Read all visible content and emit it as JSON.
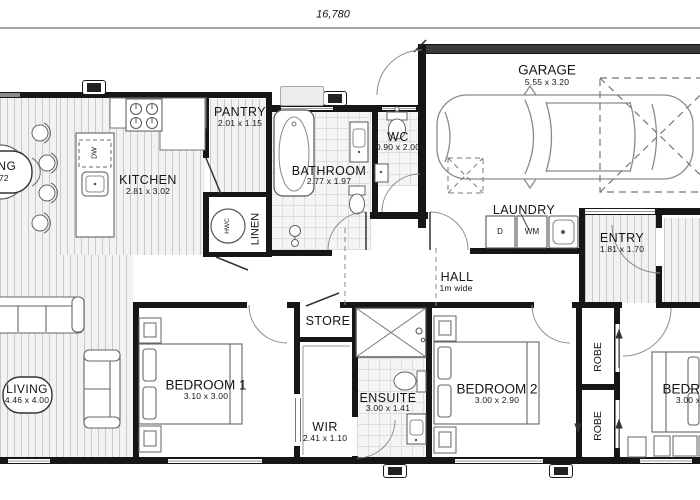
{
  "dimension_total": "16,780",
  "labels": {
    "garage": {
      "name": "GARAGE",
      "dims": "5.55 x 3.20"
    },
    "pantry": {
      "name": "PANTRY",
      "dims": "2.01 x 1.15"
    },
    "kitchen": {
      "name": "KITCHEN",
      "dims": "2.81 x 3.02"
    },
    "bathroom": {
      "name": "BATHROOM",
      "dims": "2.77 x 1.97"
    },
    "wc": {
      "name": "WC",
      "dims": "0.90 x 2.00"
    },
    "laundry": {
      "name": "LAUNDRY",
      "dryer": "D",
      "washer": "WM"
    },
    "entry": {
      "name": "ENTRY",
      "dims": "1.81 x 1.70"
    },
    "hall": {
      "name": "HALL",
      "dims": "1m wide"
    },
    "linen": {
      "name": "LINEN"
    },
    "hwc": {
      "name": "HWC"
    },
    "dw": {
      "name": "DW"
    },
    "store": {
      "name": "STORE"
    },
    "living": {
      "name": "LIVING",
      "dims": "4.46 x 4.00"
    },
    "dining": {
      "name": "DINING",
      "dims": "2.72"
    },
    "bedroom1": {
      "name": "BEDROOM 1",
      "dims": "3.10 x 3.00"
    },
    "wir": {
      "name": "WIR",
      "dims": "2.41 x 1.10"
    },
    "ensuite": {
      "name": "ENSUITE",
      "dims": "3.00 x 1.41"
    },
    "bedroom2": {
      "name": "BEDROOM 2",
      "dims": "3.00 x 2.90"
    },
    "robe_upper": {
      "name": "ROBE"
    },
    "robe_lower": {
      "name": "ROBE"
    },
    "bedroom3": {
      "name": "BEDROOM 3",
      "dims": "3.00 x 2.90"
    }
  },
  "colors": {
    "wall": "#161616",
    "floor_stripe": "#c9c9c9",
    "tile_line": "#dedede",
    "line": "#666666"
  }
}
